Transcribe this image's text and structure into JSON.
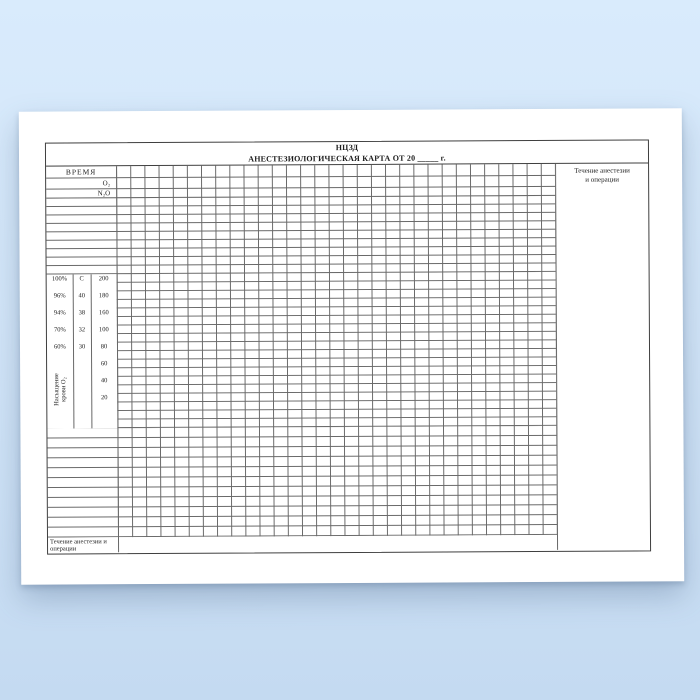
{
  "form": {
    "title_line1": "НЦЗД",
    "title_line2": "АНЕСТЕЗИОЛОГИЧЕСКАЯ КАРТА ОТ 20 _____ г.",
    "time_label": "ВРЕМЯ",
    "o2_label": "О₂",
    "n2o_label": "N₂O",
    "right_column_line1": "Течение анестезии",
    "right_column_line2": "и операции",
    "bottom_label_line1": "Течение анестезии и",
    "bottom_label_line2": "операции",
    "scale": {
      "vertical_label_line1": "Насыщение",
      "vertical_label_line2": "крови О₂",
      "saturation": [
        "100%",
        "96%",
        "94%",
        "70%",
        "60%"
      ],
      "temperature": [
        "С",
        "40",
        "38",
        "32",
        "30"
      ],
      "pulse": [
        "200",
        "180",
        "160",
        "100",
        "80",
        "60",
        "40",
        "20"
      ]
    }
  },
  "colors": {
    "background_top": "#d9ebfc",
    "background_bottom": "#c4daf1",
    "paper": "#ffffff",
    "outer_border": "#3f3f3f",
    "grid_line": "#686868",
    "text": "#1c1c1c"
  }
}
